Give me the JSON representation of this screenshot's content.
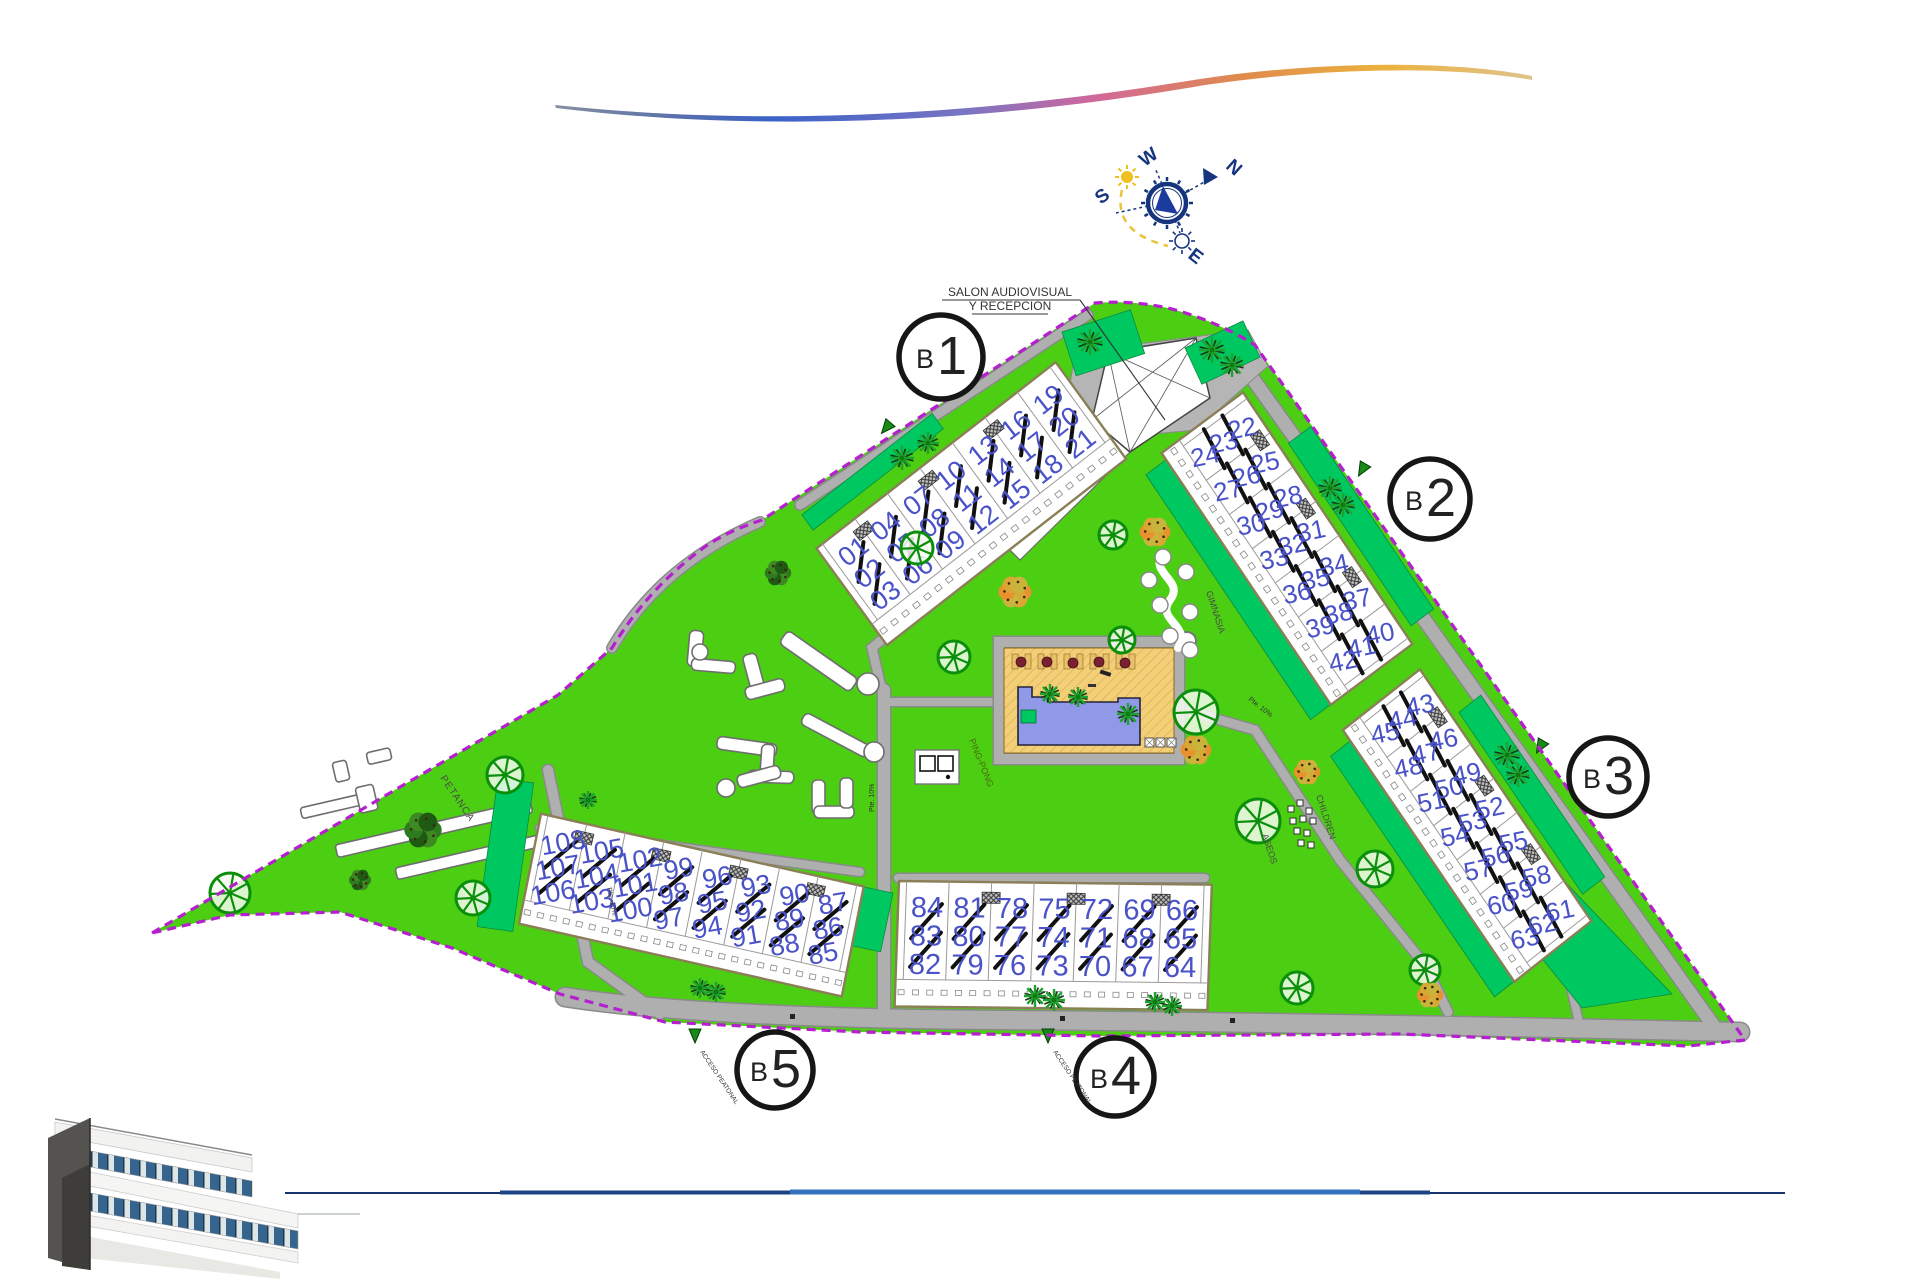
{
  "site": {
    "colors": {
      "lawn": "#4CCE12",
      "garden": "#00C860",
      "path": "#AFAFAF",
      "path_casing": "#8a8a8a",
      "boundary": "#B51FD0",
      "unit_number": "#4A52C8",
      "pool_water": "#9098E8",
      "pool_deck": "#F3CF78",
      "badge_ring": "#161616",
      "compass_blue": "#16357E",
      "bottom_line": "#16356E"
    }
  },
  "compass": {
    "n": "N",
    "s": "S",
    "e": "E",
    "w": "W"
  },
  "labels": {
    "reception1": "SALON AUDIOVISUAL",
    "reception2": "Y RECEPCIÓN",
    "petanca": "PETANCA",
    "ping_pong": "PING-PONG",
    "gimnasia": "GIMNASIA",
    "children": "CHILDREN",
    "aseos": "ASEOS",
    "slope": "Pte. 10%",
    "access": "ACCESO PEATONAL"
  },
  "blocks": [
    {
      "id": "B1",
      "badge_prefix": "B",
      "badge_number": "1",
      "strips": [
        [
          "01",
          "02",
          "03"
        ],
        [
          "04",
          "05",
          "06"
        ],
        [
          "07",
          "08",
          "09"
        ],
        [
          "10",
          "11",
          "12"
        ],
        [
          "13",
          "14",
          "15"
        ],
        [
          "16",
          "17",
          "18"
        ],
        [
          "19",
          "20",
          "21"
        ]
      ]
    },
    {
      "id": "B2",
      "badge_prefix": "B",
      "badge_number": "2",
      "strips": [
        [
          "22",
          "23",
          "24"
        ],
        [
          "25",
          "26",
          "27"
        ],
        [
          "28",
          "29",
          "30"
        ],
        [
          "31",
          "32",
          "33"
        ],
        [
          "34",
          "35",
          "36"
        ],
        [
          "37",
          "38",
          "39"
        ],
        [
          "40",
          "41",
          "42"
        ]
      ]
    },
    {
      "id": "B3",
      "badge_prefix": "B",
      "badge_number": "3",
      "strips": [
        [
          "43",
          "44",
          "45"
        ],
        [
          "46",
          "47",
          "48"
        ],
        [
          "49",
          "50",
          "51"
        ],
        [
          "52",
          "53",
          "54"
        ],
        [
          "55",
          "56",
          "57"
        ],
        [
          "58",
          "59",
          "60"
        ],
        [
          "61",
          "62",
          "63"
        ]
      ]
    },
    {
      "id": "B4",
      "badge_prefix": "B",
      "badge_number": "4",
      "strips": [
        [
          "66",
          "65",
          "64"
        ],
        [
          "69",
          "68",
          "67"
        ],
        [
          "72",
          "71",
          "70"
        ],
        [
          "75",
          "74",
          "73"
        ],
        [
          "78",
          "77",
          "76"
        ],
        [
          "81",
          "80",
          "79"
        ],
        [
          "84",
          "83",
          "82"
        ]
      ]
    },
    {
      "id": "B5",
      "badge_prefix": "B",
      "badge_number": "5",
      "strips": [
        [
          "87",
          "86",
          "85"
        ],
        [
          "90",
          "89",
          "88"
        ],
        [
          "93",
          "92",
          "91"
        ],
        [
          "96",
          "95",
          "94"
        ],
        [
          "99",
          "98",
          "97"
        ],
        [
          "102",
          "101",
          "100"
        ],
        [
          "105",
          "104",
          "103"
        ],
        [
          "108",
          "107",
          "106"
        ]
      ]
    }
  ]
}
